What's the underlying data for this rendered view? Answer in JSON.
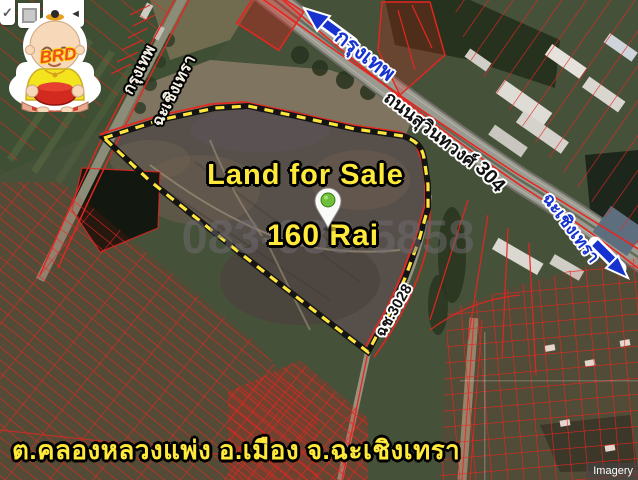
{
  "logo": {
    "text": "BRD"
  },
  "toolbar": {
    "check": "✓",
    "back": "◄"
  },
  "overlay": {
    "title": "Land for Sale",
    "area": "160 Rai",
    "phone_watermark": "083-088-5858"
  },
  "road_labels": {
    "bangkok_top": "กรุงเทพ",
    "suwinthawong_road": "ถนนสุวินทวงศ์",
    "route_304": "304",
    "chachoengsao_right": "ฉะเชิงเทรา",
    "bangkok_left": "กรุงเทพ",
    "chachoengsao_left": "ฉะเชิงเทรา",
    "road_3028": "ฉช.3028"
  },
  "caption": {
    "location": "ต.คลองหลวงแพ่ง อ.เมือง จ.ฉะเชิงเทรา"
  },
  "attribution": {
    "text": "Imagery"
  },
  "colors": {
    "highlight_yellow": "#ffe93a",
    "label_blue": "#1733cf",
    "cadastral_red": "#e8251f",
    "boundary_yellow": "#ffe63c"
  }
}
